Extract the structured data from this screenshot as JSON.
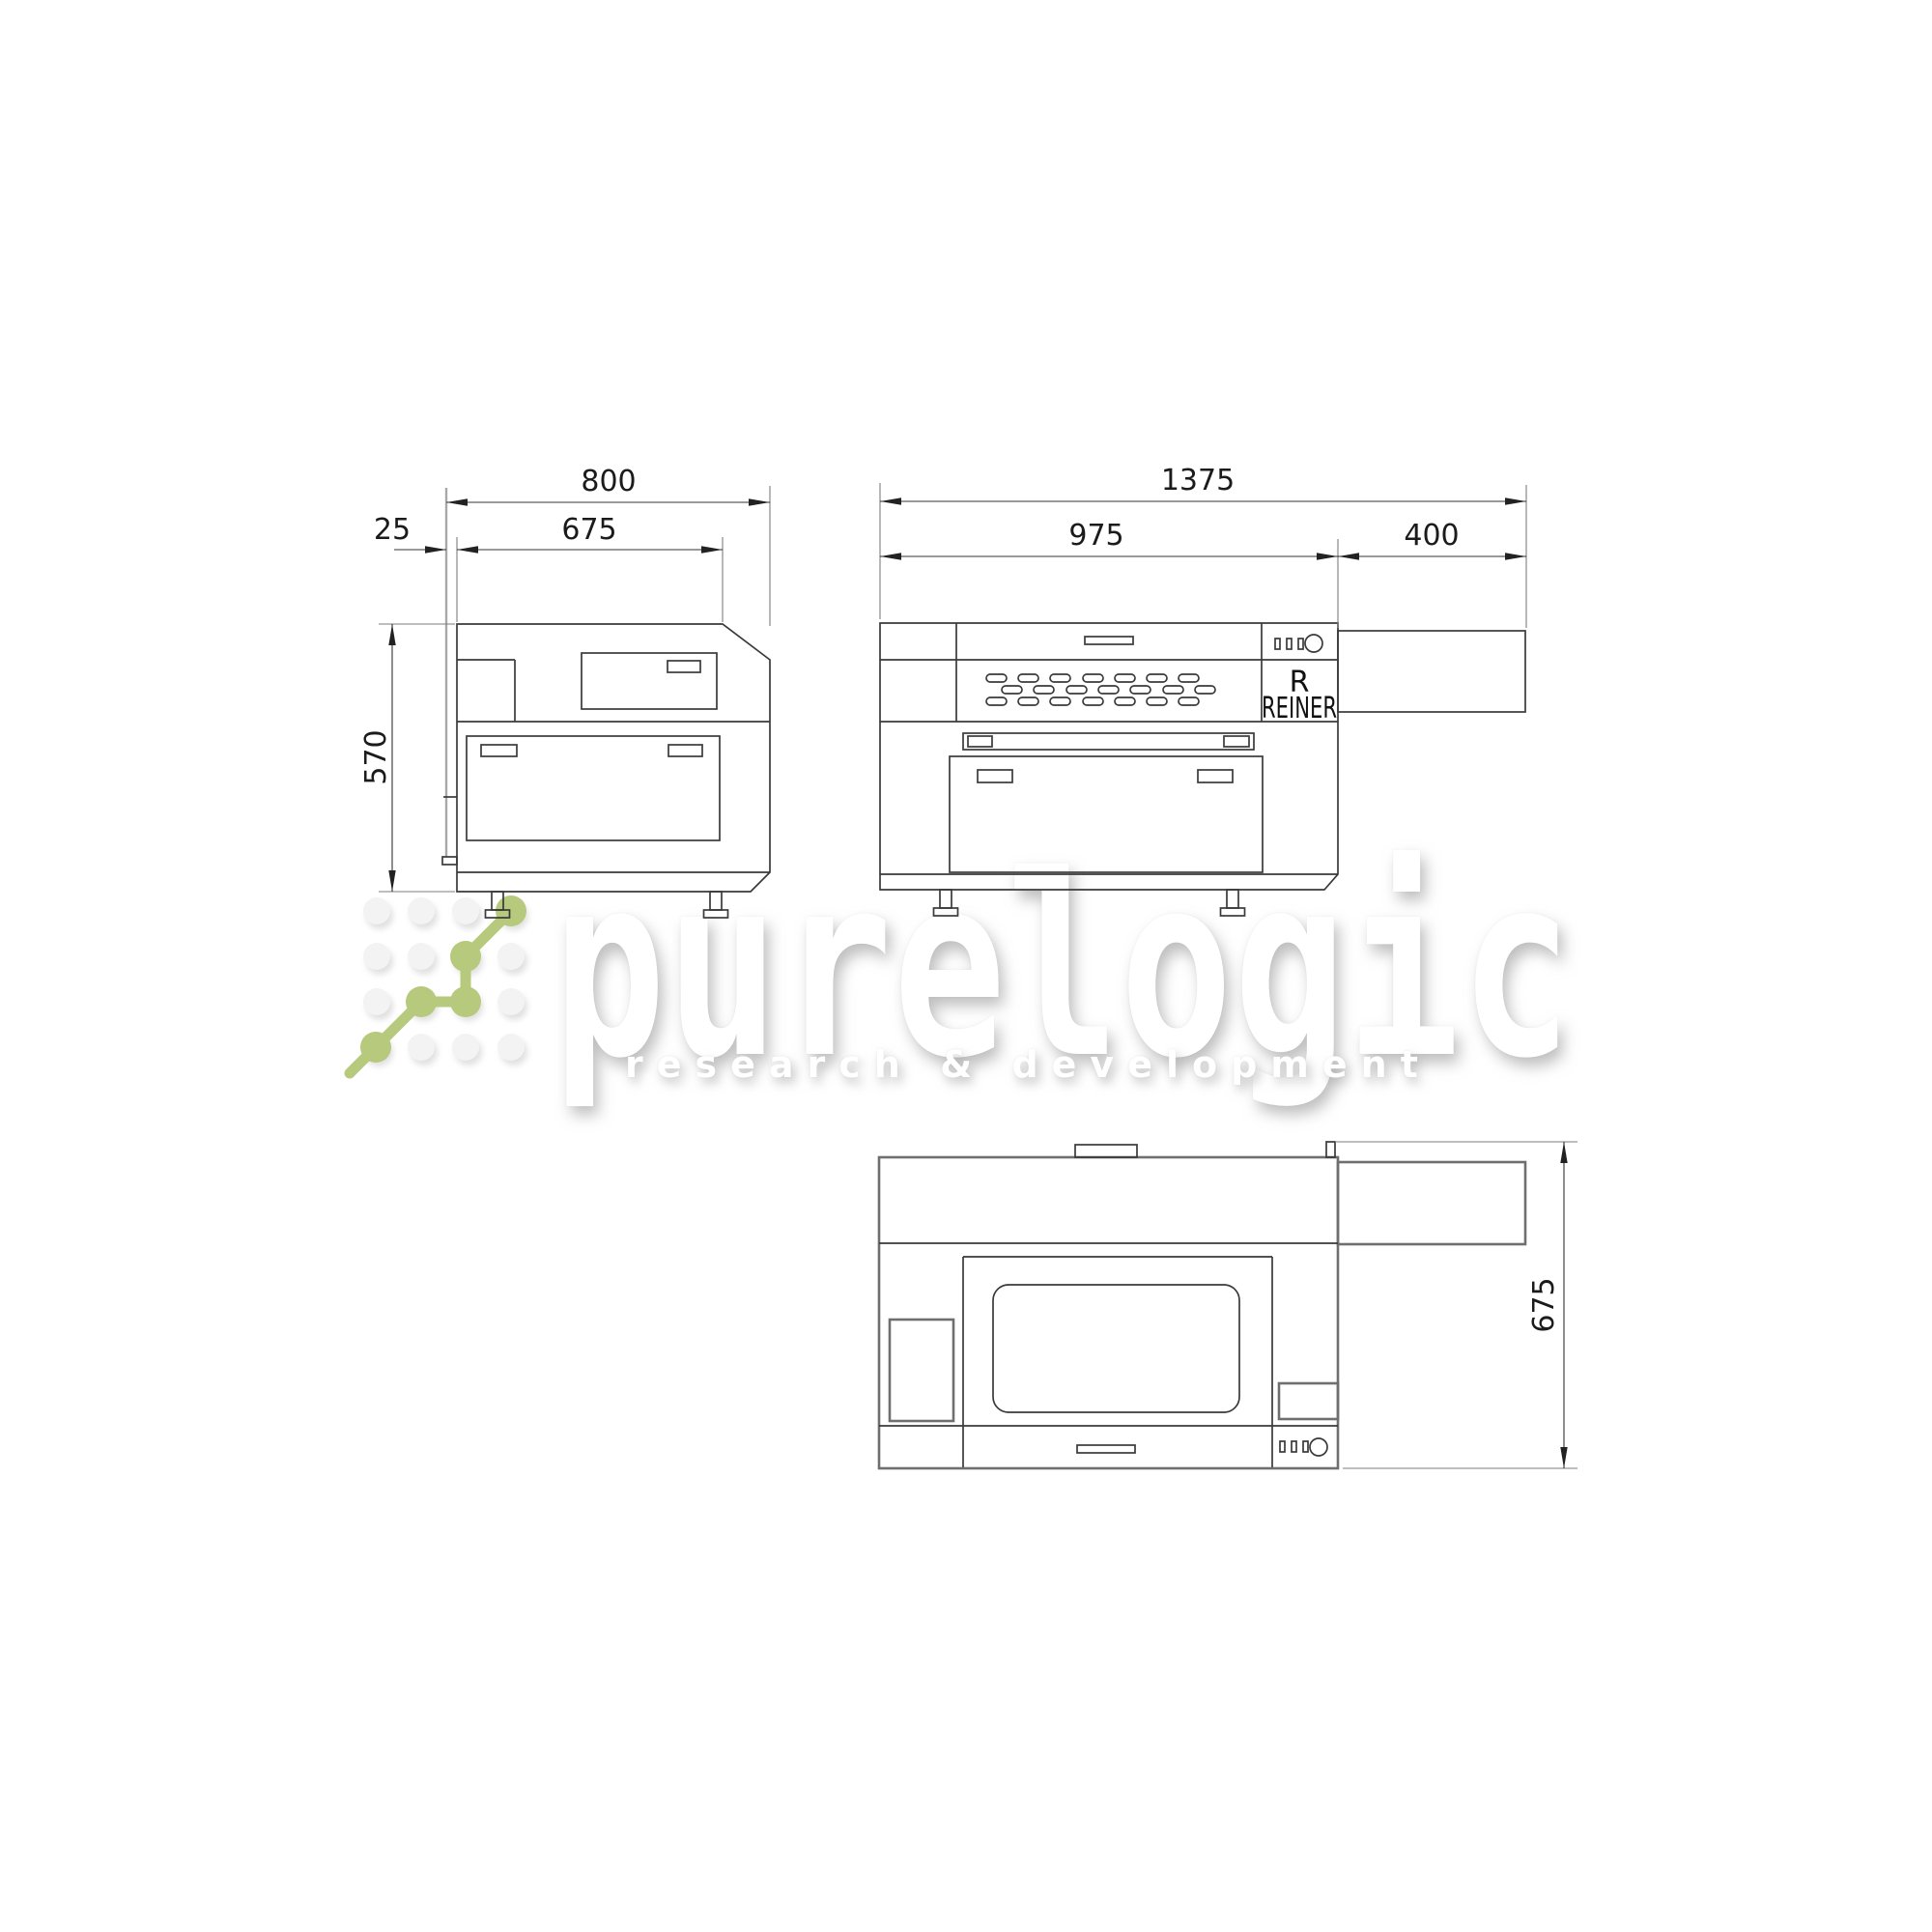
{
  "watermark": {
    "brand": "purelogic",
    "tagline": "research & development",
    "accent_green": "#b6c97c"
  },
  "machine_label": {
    "logo_letter": "R",
    "brand_name": "REINER"
  },
  "dimensions": {
    "side_view": {
      "total_depth": "800",
      "body_depth": "675",
      "wall_gap": "25",
      "height": "570"
    },
    "front_view": {
      "total_width": "1375",
      "body_width": "975",
      "extension_width": "400"
    },
    "top_view": {
      "depth": "675"
    }
  }
}
